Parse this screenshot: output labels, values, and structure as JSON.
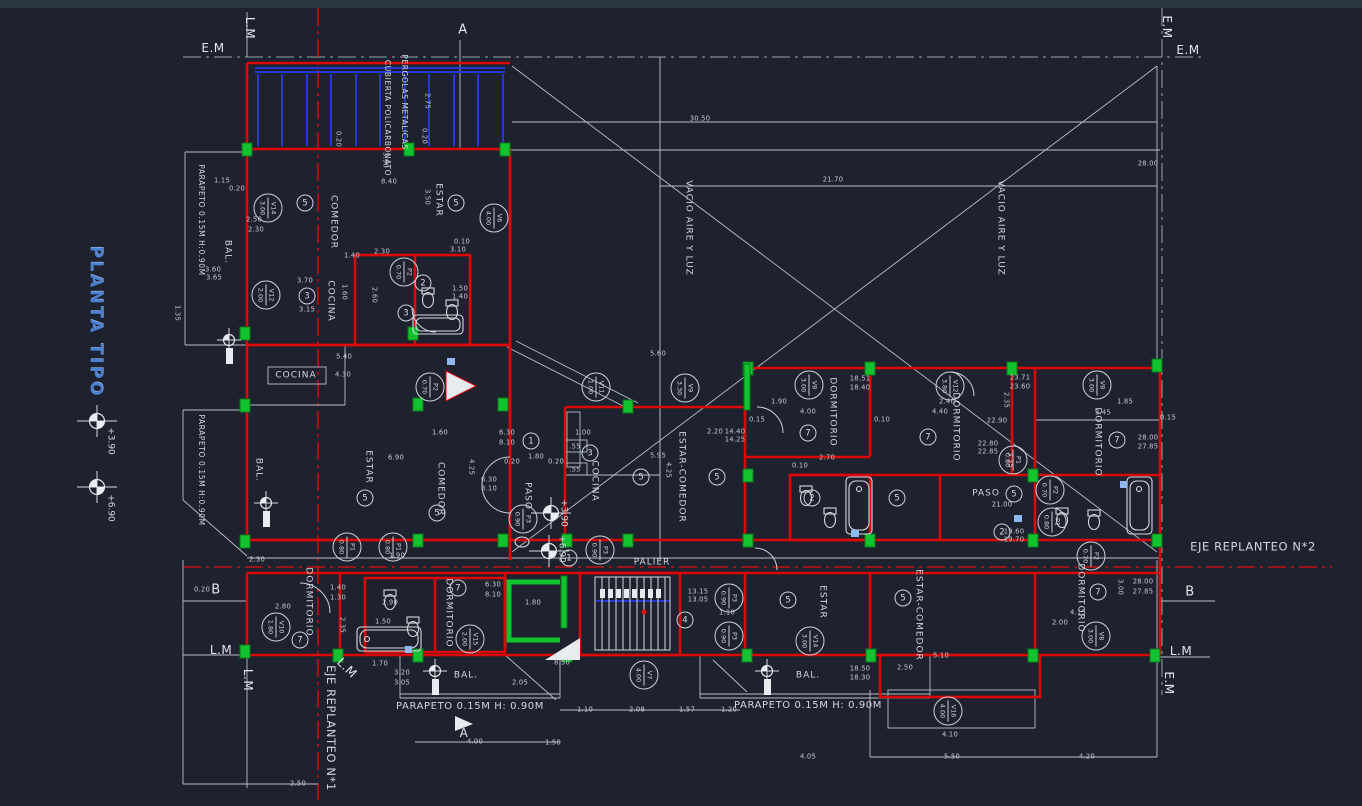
{
  "drawing": {
    "title": "PLANTA TIPO"
  },
  "colors": {
    "background": "#1d222e",
    "line_white": "#c3c9d2",
    "wall_red": "#da0808",
    "column_green": "#12c32f",
    "pergola_blue": "#2836d6",
    "centerline_red": "#e20d0d",
    "title_blue": "#4d7fd0",
    "sill_blue": "#8fb8f0"
  },
  "rooms": [
    {
      "t": "COMEDOR",
      "x": 333,
      "y": 222,
      "r": 90
    },
    {
      "t": "ESTAR",
      "x": 438,
      "y": 200,
      "r": 90
    },
    {
      "t": "BAL.",
      "x": 227,
      "y": 252,
      "r": 90
    },
    {
      "t": "COCINA",
      "x": 330,
      "y": 301,
      "r": 90
    },
    {
      "t": "COCINA",
      "x": 296,
      "y": 376,
      "r": 0
    },
    {
      "t": "ESTAR",
      "x": 368,
      "y": 467,
      "r": 90
    },
    {
      "t": "COMEDOR",
      "x": 440,
      "y": 489,
      "r": 90
    },
    {
      "t": "BAL.",
      "x": 258,
      "y": 470,
      "r": 90
    },
    {
      "t": "PASO",
      "x": 527,
      "y": 496,
      "r": 90
    },
    {
      "t": "COCINA",
      "x": 594,
      "y": 481,
      "r": 90
    },
    {
      "t": "ESTAR-COMEDOR",
      "x": 681,
      "y": 477,
      "r": 90
    },
    {
      "t": "PALIER",
      "x": 652,
      "y": 563,
      "r": 0
    },
    {
      "t": "DORMITORIO",
      "x": 832,
      "y": 412,
      "r": 90
    },
    {
      "t": "DORMITORIO",
      "x": 955,
      "y": 427,
      "r": 90
    },
    {
      "t": "DORMITORIO",
      "x": 1097,
      "y": 442,
      "r": 90
    },
    {
      "t": "PASO",
      "x": 986,
      "y": 494,
      "r": 0
    },
    {
      "t": "DORMITORIO",
      "x": 308,
      "y": 602,
      "r": 90
    },
    {
      "t": "DORMITORIO",
      "x": 448,
      "y": 613,
      "r": 90
    },
    {
      "t": "ESTAR",
      "x": 822,
      "y": 602,
      "r": 90
    },
    {
      "t": "ESTAR-COMEDOR",
      "x": 918,
      "y": 615,
      "r": 90
    },
    {
      "t": "DORMITORIO",
      "x": 1080,
      "y": 598,
      "r": 90
    },
    {
      "t": "BAL.",
      "x": 466,
      "y": 676,
      "r": 0
    },
    {
      "t": "BAL.",
      "x": 808,
      "y": 676,
      "r": 0
    },
    {
      "t": "VACIO AIRE Y LUZ",
      "x": 688,
      "y": 228,
      "r": 90
    },
    {
      "t": "VACIO AIRE Y LUZ",
      "x": 1000,
      "y": 228,
      "r": 90
    }
  ],
  "annotations": [
    {
      "t": "PERGOLAS METALICAS",
      "x": 404,
      "y": 102,
      "r": 90,
      "s": 7.5
    },
    {
      "t": "CUBIERTA POLICARBONATO",
      "x": 387,
      "y": 118,
      "r": 90,
      "s": 7.5
    },
    {
      "t": "PARAPETO 0.15M H:0.90M",
      "x": 201,
      "y": 220,
      "r": 90,
      "s": 7.5
    },
    {
      "t": "PARAPETO 0.15M H:0.90M",
      "x": 201,
      "y": 470,
      "r": 90,
      "s": 7.5
    },
    {
      "t": "PARAPETO 0.15M H: 0.90M",
      "x": 470,
      "y": 707,
      "r": 0,
      "s": 10
    },
    {
      "t": "PARAPETO 0.15M H: 0.90M",
      "x": 808,
      "y": 706,
      "r": 0,
      "s": 10
    },
    {
      "t": "EJE REPLANTEO N*2",
      "x": 1253,
      "y": 547,
      "r": 0,
      "s": 11.5
    },
    {
      "t": "EJE REPLANTEO N*1",
      "x": 330,
      "y": 728,
      "r": 90,
      "s": 11.5
    }
  ],
  "markers": [
    {
      "t": "E.M",
      "x": 213,
      "y": 48,
      "r": 0
    },
    {
      "t": "L.M",
      "x": 250,
      "y": 28,
      "r": 90
    },
    {
      "t": "A",
      "x": 463,
      "y": 30,
      "r": 0,
      "s": 13
    },
    {
      "t": "E.M",
      "x": 1167,
      "y": 27,
      "r": 90
    },
    {
      "t": "E.M",
      "x": 1188,
      "y": 50,
      "r": 0
    },
    {
      "t": "B",
      "x": 216,
      "y": 590,
      "r": 0,
      "s": 13
    },
    {
      "t": "B",
      "x": 1190,
      "y": 592,
      "r": 0,
      "s": 13
    },
    {
      "t": "L.M",
      "x": 221,
      "y": 650,
      "r": 0
    },
    {
      "t": "L.M",
      "x": 248,
      "y": 680,
      "r": 90
    },
    {
      "t": "L.M",
      "x": 347,
      "y": 668,
      "r": 45
    },
    {
      "t": "L.M",
      "x": 1181,
      "y": 651,
      "r": 0
    },
    {
      "t": "E.M",
      "x": 1169,
      "y": 683,
      "r": 90
    },
    {
      "t": "A",
      "x": 464,
      "y": 733,
      "r": 0,
      "s": 12
    }
  ],
  "levels": [
    {
      "t": "+3.90",
      "x": 110,
      "y": 441,
      "r": 90
    },
    {
      "t": "+6.90",
      "x": 110,
      "y": 508,
      "r": 90
    },
    {
      "t": "+3.90",
      "x": 563,
      "y": 513,
      "r": 90
    },
    {
      "t": "+6.90",
      "x": 561,
      "y": 549,
      "r": 90
    }
  ],
  "dims": [
    {
      "t": "30.50",
      "x": 700,
      "y": 119
    },
    {
      "t": "21.70",
      "x": 833,
      "y": 180
    },
    {
      "t": "28.00",
      "x": 1148,
      "y": 164
    },
    {
      "t": "2.75",
      "x": 427,
      "y": 101,
      "r": 90
    },
    {
      "t": "0.20",
      "x": 338,
      "y": 139,
      "r": 90
    },
    {
      "t": "0.20",
      "x": 424,
      "y": 136,
      "r": 90
    },
    {
      "t": "3.90",
      "x": 385,
      "y": 160,
      "r": 90
    },
    {
      "t": "1.15",
      "x": 222,
      "y": 181
    },
    {
      "t": "0.20",
      "x": 237,
      "y": 189
    },
    {
      "t": "8.40",
      "x": 389,
      "y": 182
    },
    {
      "t": "3.50",
      "x": 427,
      "y": 197,
      "r": 90
    },
    {
      "t": "2.50",
      "x": 254,
      "y": 220
    },
    {
      "t": "2.30",
      "x": 256,
      "y": 230
    },
    {
      "t": "3.60",
      "x": 213,
      "y": 270
    },
    {
      "t": "3.65",
      "x": 214,
      "y": 278
    },
    {
      "t": "1.35",
      "x": 177,
      "y": 313,
      "r": 90
    },
    {
      "t": "1.40",
      "x": 352,
      "y": 256
    },
    {
      "t": "2.30",
      "x": 382,
      "y": 252
    },
    {
      "t": "3.10",
      "x": 458,
      "y": 250
    },
    {
      "t": "0.10",
      "x": 462,
      "y": 242
    },
    {
      "t": "1.60",
      "x": 344,
      "y": 292,
      "r": 90
    },
    {
      "t": "2.60",
      "x": 374,
      "y": 295,
      "r": 90
    },
    {
      "t": "3.70",
      "x": 305,
      "y": 281
    },
    {
      "t": "3.15",
      "x": 307,
      "y": 310
    },
    {
      "t": "1.50",
      "x": 460,
      "y": 289
    },
    {
      "t": "1.40",
      "x": 460,
      "y": 297
    },
    {
      "t": "5.40",
      "x": 344,
      "y": 357
    },
    {
      "t": "4.30",
      "x": 343,
      "y": 375
    },
    {
      "t": "6.30",
      "x": 507,
      "y": 433
    },
    {
      "t": "8.10",
      "x": 507,
      "y": 443
    },
    {
      "t": "4.25",
      "x": 471,
      "y": 467,
      "r": 90
    },
    {
      "t": "6.90",
      "x": 396,
      "y": 458
    },
    {
      "t": "1.60",
      "x": 440,
      "y": 433
    },
    {
      "t": "1.90",
      "x": 397,
      "y": 556
    },
    {
      "t": "1.80",
      "x": 536,
      "y": 457
    },
    {
      "t": "0.20",
      "x": 512,
      "y": 462
    },
    {
      "t": "0.20",
      "x": 556,
      "y": 462
    },
    {
      "t": "1.00",
      "x": 583,
      "y": 433
    },
    {
      "t": "5.95",
      "x": 658,
      "y": 456
    },
    {
      "t": "4.25",
      "x": 668,
      "y": 470,
      "r": 90
    },
    {
      "t": "5.60",
      "x": 658,
      "y": 354
    },
    {
      "t": "14.40",
      "x": 735,
      "y": 432
    },
    {
      "t": "14.25",
      "x": 735,
      "y": 440
    },
    {
      "t": "2.20",
      "x": 715,
      "y": 432
    },
    {
      "t": "18.51",
      "x": 860,
      "y": 379
    },
    {
      "t": "18.40",
      "x": 860,
      "y": 388
    },
    {
      "t": "1.90",
      "x": 779,
      "y": 402
    },
    {
      "t": "2.40",
      "x": 947,
      "y": 402
    },
    {
      "t": "4.00",
      "x": 808,
      "y": 412
    },
    {
      "t": "4.40",
      "x": 940,
      "y": 412
    },
    {
      "t": "2.70",
      "x": 827,
      "y": 458
    },
    {
      "t": "22.90",
      "x": 997,
      "y": 421
    },
    {
      "t": "22.80",
      "x": 988,
      "y": 444
    },
    {
      "t": "22.85",
      "x": 988,
      "y": 452
    },
    {
      "t": "23.71",
      "x": 1020,
      "y": 378
    },
    {
      "t": "23.60",
      "x": 1020,
      "y": 387
    },
    {
      "t": "1.85",
      "x": 1125,
      "y": 402
    },
    {
      "t": "3.45",
      "x": 1103,
      "y": 413
    },
    {
      "t": "28.00",
      "x": 1148,
      "y": 438
    },
    {
      "t": "27.85",
      "x": 1148,
      "y": 447
    },
    {
      "t": "21.00",
      "x": 1002,
      "y": 505
    },
    {
      "t": "19.60",
      "x": 1014,
      "y": 532
    },
    {
      "t": "19.70",
      "x": 1014,
      "y": 540
    },
    {
      "t": "0.15",
      "x": 1168,
      "y": 418
    },
    {
      "t": "13.15",
      "x": 698,
      "y": 592
    },
    {
      "t": "13.05",
      "x": 698,
      "y": 600
    },
    {
      "t": "1.10",
      "x": 727,
      "y": 613
    },
    {
      "t": "18.50",
      "x": 860,
      "y": 669
    },
    {
      "t": "18.30",
      "x": 860,
      "y": 678
    },
    {
      "t": "2.50",
      "x": 905,
      "y": 668
    },
    {
      "t": "5.10",
      "x": 941,
      "y": 656
    },
    {
      "t": "1.20",
      "x": 729,
      "y": 710
    },
    {
      "t": "4.05",
      "x": 808,
      "y": 757
    },
    {
      "t": "1.57",
      "x": 687,
      "y": 710
    },
    {
      "t": "1.10",
      "x": 585,
      "y": 710
    },
    {
      "t": "2.08",
      "x": 637,
      "y": 710
    },
    {
      "t": "4.00",
      "x": 475,
      "y": 742
    },
    {
      "t": "1.50",
      "x": 553,
      "y": 743
    },
    {
      "t": "2.05",
      "x": 520,
      "y": 683
    },
    {
      "t": "8.50",
      "x": 562,
      "y": 663
    },
    {
      "t": "3.20",
      "x": 402,
      "y": 673
    },
    {
      "t": "3.05",
      "x": 402,
      "y": 683
    },
    {
      "t": "1.70",
      "x": 380,
      "y": 664
    },
    {
      "t": "5.50",
      "x": 952,
      "y": 757
    },
    {
      "t": "4.20",
      "x": 1087,
      "y": 757
    },
    {
      "t": "4.10",
      "x": 950,
      "y": 735
    },
    {
      "t": "28.00",
      "x": 1143,
      "y": 582
    },
    {
      "t": "27.85",
      "x": 1143,
      "y": 592
    },
    {
      "t": "4.15",
      "x": 1078,
      "y": 613
    },
    {
      "t": "2.00",
      "x": 1060,
      "y": 623
    },
    {
      "t": "3.00",
      "x": 1120,
      "y": 587,
      "r": 90
    },
    {
      "t": "2.50",
      "x": 298,
      "y": 784
    },
    {
      "t": "0.20",
      "x": 202,
      "y": 590
    },
    {
      "t": "2.30",
      "x": 257,
      "y": 560
    },
    {
      "t": "2.80",
      "x": 283,
      "y": 607
    },
    {
      "t": "1.40",
      "x": 338,
      "y": 588
    },
    {
      "t": "1.30",
      "x": 338,
      "y": 598
    },
    {
      "t": "2.35",
      "x": 342,
      "y": 625,
      "r": 90
    },
    {
      "t": "2.90",
      "x": 390,
      "y": 603
    },
    {
      "t": "1.50",
      "x": 383,
      "y": 622
    },
    {
      "t": "1.80",
      "x": 533,
      "y": 603
    },
    {
      "t": "6.30",
      "x": 493,
      "y": 585
    },
    {
      "t": "8.10",
      "x": 493,
      "y": 595
    },
    {
      "t": "6.30",
      "x": 489,
      "y": 480
    },
    {
      "t": "8.10",
      "x": 489,
      "y": 489
    },
    {
      "t": ".55",
      "x": 575,
      "y": 447
    },
    {
      "t": ".55",
      "x": 575,
      "y": 470
    },
    {
      "t": "0.10",
      "x": 800,
      "y": 466
    },
    {
      "t": "0.15",
      "x": 757,
      "y": 420
    },
    {
      "t": "0.10",
      "x": 882,
      "y": 420
    },
    {
      "t": "2.35",
      "x": 1006,
      "y": 400,
      "r": 90
    },
    {
      "t": "3.35",
      "x": 1010,
      "y": 460,
      "r": 90
    }
  ],
  "codes": [
    {
      "code": "V14",
      "value": "3.00",
      "x": 268,
      "y": 208
    },
    {
      "code": "V12",
      "value": "2.00",
      "x": 266,
      "y": 295
    },
    {
      "code": "V6",
      "value": "4.00",
      "x": 494,
      "y": 218
    },
    {
      "code": "V11",
      "value": "1.00",
      "x": 596,
      "y": 387
    },
    {
      "code": "V9",
      "value": "3.30",
      "x": 685,
      "y": 388
    },
    {
      "code": "V8",
      "value": "3.00",
      "x": 809,
      "y": 385
    },
    {
      "code": "V12",
      "value": "3.80",
      "x": 950,
      "y": 386
    },
    {
      "code": "V8",
      "value": "3.00",
      "x": 1097,
      "y": 385
    },
    {
      "code": "V10",
      "value": "1.80",
      "x": 276,
      "y": 627
    },
    {
      "code": "V15",
      "value": "2.00",
      "x": 470,
      "y": 639
    },
    {
      "code": "V7",
      "value": "4.00",
      "x": 644,
      "y": 675
    },
    {
      "code": "V14",
      "value": "3.00",
      "x": 810,
      "y": 641
    },
    {
      "code": "V8",
      "value": "3.00",
      "x": 1096,
      "y": 636
    },
    {
      "code": "V16",
      "value": "4.00",
      "x": 948,
      "y": 711
    },
    {
      "code": "P2",
      "value": "0.70",
      "x": 404,
      "y": 272
    },
    {
      "code": "P2",
      "value": "0.70",
      "x": 430,
      "y": 387
    },
    {
      "code": "P3",
      "value": "0.90",
      "x": 523,
      "y": 519
    },
    {
      "code": "P3",
      "value": "0.90",
      "x": 600,
      "y": 550
    },
    {
      "code": "P1",
      "value": "0.80",
      "x": 347,
      "y": 547
    },
    {
      "code": "P1",
      "value": "0.80",
      "x": 393,
      "y": 547
    },
    {
      "code": "P1",
      "value": "0.80",
      "x": 1013,
      "y": 460
    },
    {
      "code": "P2",
      "value": "0.70",
      "x": 1050,
      "y": 490
    },
    {
      "code": "P1",
      "value": "0.80",
      "x": 1052,
      "y": 522
    },
    {
      "code": "P2",
      "value": "0.70",
      "x": 1091,
      "y": 556
    },
    {
      "code": "P3",
      "value": "0.90",
      "x": 729,
      "y": 598
    },
    {
      "code": "P3",
      "value": "0.90",
      "x": 729,
      "y": 636
    }
  ],
  "room_numbers": [
    {
      "n": "5",
      "x": 305,
      "y": 203
    },
    {
      "n": "5",
      "x": 456,
      "y": 203
    },
    {
      "n": "5",
      "x": 365,
      "y": 498
    },
    {
      "n": "5",
      "x": 437,
      "y": 513
    },
    {
      "n": "5",
      "x": 641,
      "y": 477
    },
    {
      "n": "5",
      "x": 717,
      "y": 477
    },
    {
      "n": "5",
      "x": 897,
      "y": 498
    },
    {
      "n": "5",
      "x": 1014,
      "y": 494
    },
    {
      "n": "5",
      "x": 788,
      "y": 600
    },
    {
      "n": "5",
      "x": 903,
      "y": 598
    },
    {
      "n": "3",
      "x": 307,
      "y": 296
    },
    {
      "n": "3",
      "x": 406,
      "y": 313
    },
    {
      "n": "3",
      "x": 590,
      "y": 453
    },
    {
      "n": "1",
      "x": 531,
      "y": 441
    },
    {
      "n": "1",
      "x": 569,
      "y": 558
    },
    {
      "n": "7",
      "x": 808,
      "y": 433
    },
    {
      "n": "7",
      "x": 928,
      "y": 437
    },
    {
      "n": "7",
      "x": 1117,
      "y": 440
    },
    {
      "n": "7",
      "x": 300,
      "y": 640
    },
    {
      "n": "7",
      "x": 458,
      "y": 588
    },
    {
      "n": "7",
      "x": 1098,
      "y": 592
    },
    {
      "n": "4",
      "x": 685,
      "y": 620
    },
    {
      "n": "2",
      "x": 423,
      "y": 283
    },
    {
      "n": "2",
      "x": 812,
      "y": 498
    },
    {
      "n": "2",
      "x": 1002,
      "y": 532
    }
  ],
  "symbols": {
    "level_markers": [
      {
        "x": 97,
        "y": 421
      },
      {
        "x": 97,
        "y": 487
      },
      {
        "x": 551,
        "y": 513
      },
      {
        "x": 549,
        "y": 551
      }
    ],
    "drains": [
      {
        "x": 229,
        "y": 340
      },
      {
        "x": 266,
        "y": 503
      },
      {
        "x": 435,
        "y": 671
      },
      {
        "x": 767,
        "y": 671
      }
    ]
  }
}
